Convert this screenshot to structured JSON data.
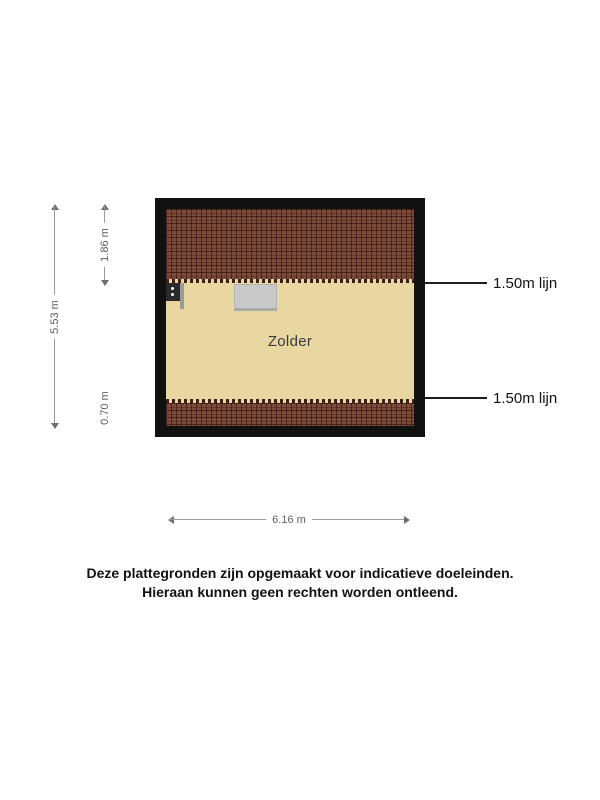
{
  "plan": {
    "room_label": "Zolder",
    "dimensions": {
      "total_height": "5.53 m",
      "top_roof_height": "1.86 m",
      "bottom_roof_height": "0.70 m",
      "width": "6.16 m"
    },
    "callouts": [
      {
        "label": "1.50m lijn"
      },
      {
        "label": "1.50m lijn"
      }
    ]
  },
  "disclaimer": {
    "line1": "Deze plattegronden zijn opgemaakt voor indicatieve doeleinden.",
    "line2": "Hieraan kunnen geen rechten worden ontleend."
  },
  "colors": {
    "wall_border": "#111111",
    "roof_tile": "#7d4b3a",
    "floor": "#e9d7a2",
    "roof_window": "#c9c9c9",
    "dimension_line": "#9a9a9a",
    "dimension_text": "#5f5f5f",
    "callout_line": "#1d1d1d",
    "text": "#111111"
  }
}
